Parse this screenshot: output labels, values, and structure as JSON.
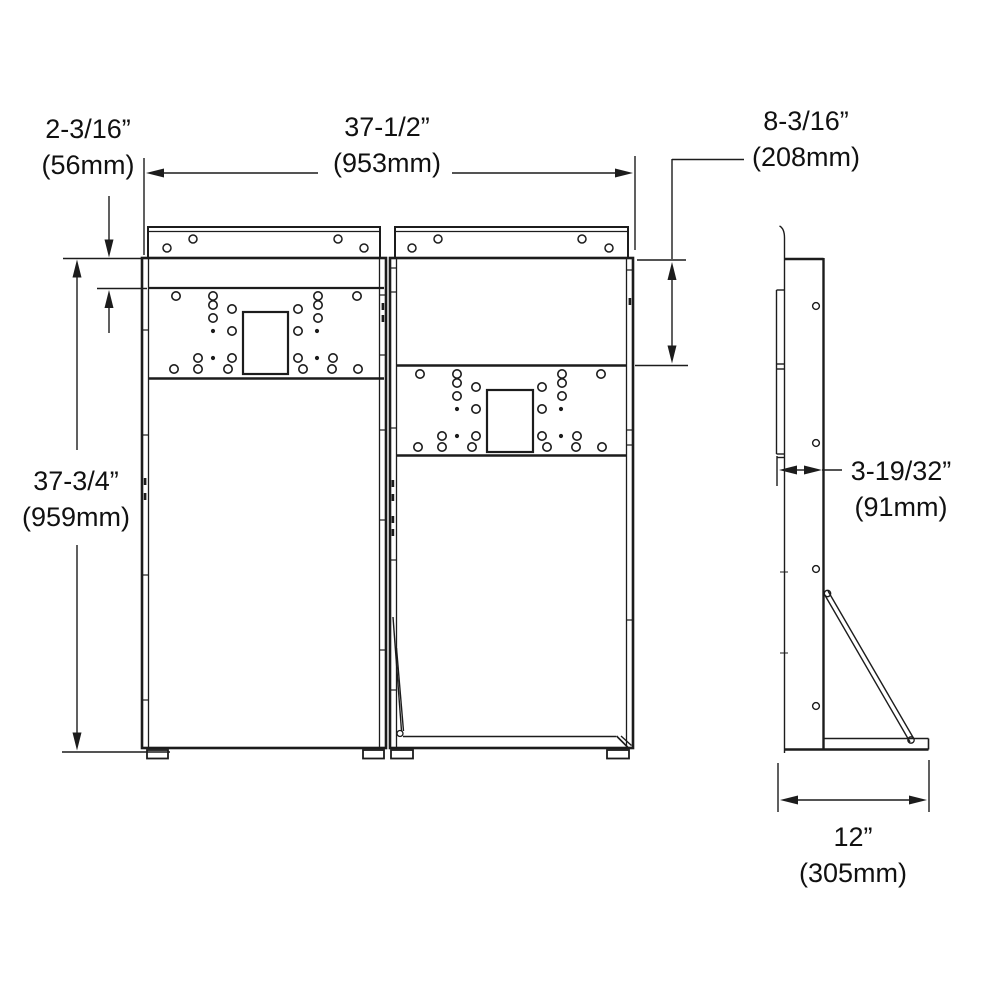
{
  "colors": {
    "line": "#1c1c1c",
    "text": "#111111",
    "background": "#ffffff"
  },
  "dimension_labels": {
    "mount_offset": {
      "inches": "2-3/16”",
      "metric": "(56mm)"
    },
    "overall_width": {
      "inches": "37-1/2”",
      "metric": "(953mm)"
    },
    "upper_section_height": {
      "inches": "8-3/16”",
      "metric": "(208mm)"
    },
    "overall_height": {
      "inches": "37-3/4”",
      "metric": "(959mm)"
    },
    "frame_depth": {
      "inches": "3-19/32”",
      "metric": "(91mm)"
    },
    "base_depth": {
      "inches": "12”",
      "metric": "(305mm)"
    }
  }
}
